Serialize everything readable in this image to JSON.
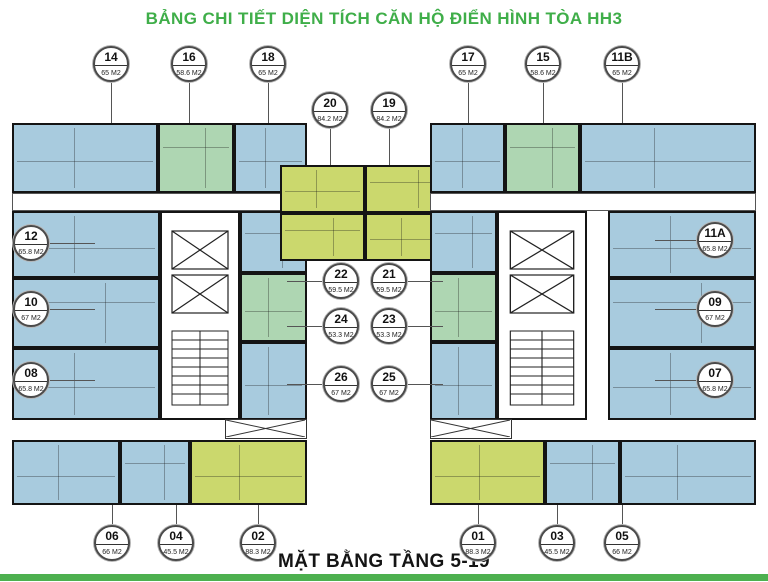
{
  "title": "BẢNG CHI TIẾT DIỆN TÍCH CĂN HỘ ĐIỂN HÌNH TÒA HH3",
  "footer_title": "MẶT BẰNG TẦNG 5-19",
  "units": [
    {
      "no": "14",
      "area": "65 M2",
      "color": "blue"
    },
    {
      "no": "16",
      "area": "58.6 M2",
      "color": "green"
    },
    {
      "no": "18",
      "area": "65 M2",
      "color": "blue"
    },
    {
      "no": "20",
      "area": "84.2 M2",
      "color": "lime"
    },
    {
      "no": "19",
      "area": "84.2 M2",
      "color": "lime"
    },
    {
      "no": "17",
      "area": "65 M2",
      "color": "blue"
    },
    {
      "no": "15",
      "area": "58.6 M2",
      "color": "green"
    },
    {
      "no": "11B",
      "area": "65 M2",
      "color": "blue"
    },
    {
      "no": "12",
      "area": "65.8 M2",
      "color": "blue"
    },
    {
      "no": "10",
      "area": "67 M2",
      "color": "blue"
    },
    {
      "no": "08",
      "area": "65.8 M2",
      "color": "blue"
    },
    {
      "no": "11A",
      "area": "65.8 M2",
      "color": "blue"
    },
    {
      "no": "09",
      "area": "67 M2",
      "color": "blue"
    },
    {
      "no": "07",
      "area": "65.8 M2",
      "color": "blue"
    },
    {
      "no": "22",
      "area": "59.5 M2",
      "color": "lime"
    },
    {
      "no": "21",
      "area": "59.5 M2",
      "color": "lime"
    },
    {
      "no": "24",
      "area": "53.3 M2",
      "color": "green"
    },
    {
      "no": "23",
      "area": "53.3 M2",
      "color": "green"
    },
    {
      "no": "26",
      "area": "67 M2",
      "color": "blue"
    },
    {
      "no": "25",
      "area": "67 M2",
      "color": "blue"
    },
    {
      "no": "06",
      "area": "66 M2",
      "color": "blue"
    },
    {
      "no": "04",
      "area": "45.5 M2",
      "color": "blue"
    },
    {
      "no": "02",
      "area": "88.3 M2",
      "color": "lime"
    },
    {
      "no": "01",
      "area": "88.3 M2",
      "color": "lime"
    },
    {
      "no": "03",
      "area": "45.5 M2",
      "color": "blue"
    },
    {
      "no": "05",
      "area": "66 M2",
      "color": "blue"
    }
  ],
  "colors": {
    "apartment_blue": "#a8cbde",
    "apartment_green": "#aed6b2",
    "apartment_lime": "#cbd86d",
    "title_green": "#3fae49",
    "footer_bar_green": "#4db04f",
    "wall_black": "#141414"
  }
}
